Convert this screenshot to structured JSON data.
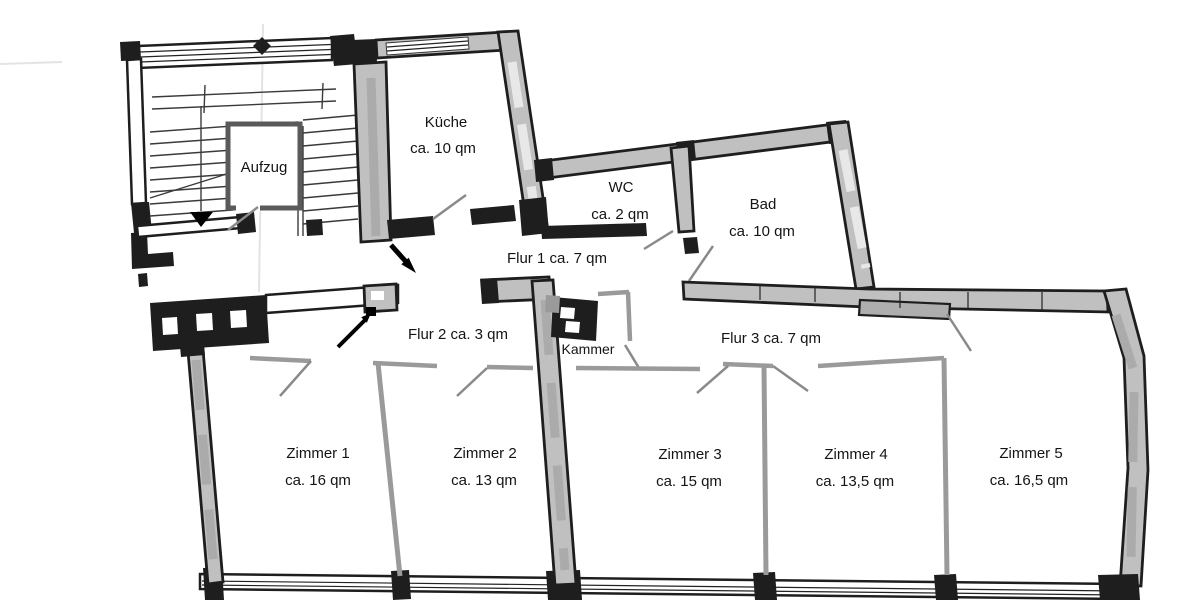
{
  "plan": {
    "type": "apartment-floor-plan",
    "language": "de"
  },
  "rooms": {
    "aufzug": {
      "label": "Aufzug"
    },
    "kueche": {
      "label": "Küche",
      "area": "ca. 10 qm"
    },
    "wc": {
      "label": "WC",
      "area": "ca. 2 qm"
    },
    "bad": {
      "label": "Bad",
      "area": "ca. 10 qm"
    },
    "flur1": {
      "label": "Flur 1 ca. 7 qm"
    },
    "flur2": {
      "label": "Flur 2 ca. 3 qm"
    },
    "flur3": {
      "label": "Flur 3 ca. 7 qm"
    },
    "kammer": {
      "label": "Kammer"
    },
    "zimmer1": {
      "label": "Zimmer 1",
      "area": "ca. 16 qm"
    },
    "zimmer2": {
      "label": "Zimmer 2",
      "area": "ca. 13 qm"
    },
    "zimmer3": {
      "label": "Zimmer 3",
      "area": "ca. 15 qm"
    },
    "zimmer4": {
      "label": "Zimmer 4",
      "area": "ca. 13,5 qm"
    },
    "zimmer5": {
      "label": "Zimmer 5",
      "area": "ca. 16,5 qm"
    }
  },
  "colors": {
    "background": "#ffffff",
    "wall": "#1e1e1e",
    "wall_fill": "#c0c0c0",
    "partition": "#9a9a9a",
    "door": "#8a8a8a",
    "arrow": "#000000"
  }
}
